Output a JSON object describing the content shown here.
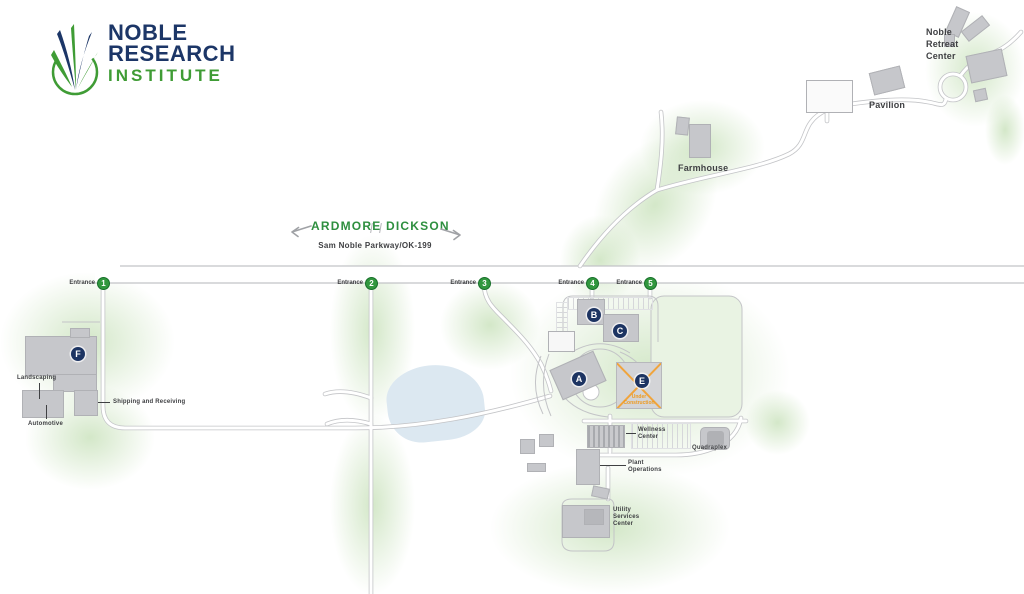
{
  "logo": {
    "line1": "NOBLE",
    "line2": "RESEARCH",
    "line3": "INSTITUTE"
  },
  "directions": {
    "west": "ARDMORE",
    "east": "DICKSON",
    "road": "Sam Noble Parkway/OK-199"
  },
  "entrances": [
    {
      "label": "Entrance",
      "number": "1"
    },
    {
      "label": "Entrance",
      "number": "2"
    },
    {
      "label": "Entrance",
      "number": "3"
    },
    {
      "label": "Entrance",
      "number": "4"
    },
    {
      "label": "Entrance",
      "number": "5"
    }
  ],
  "markers": {
    "a": "A",
    "b": "B",
    "c": "C",
    "e": "E",
    "f": "F"
  },
  "labels": {
    "noble_retreat_center": "Noble\nRetreat\nCenter",
    "pavilion": "Pavilion",
    "farmhouse": "Farmhouse",
    "landscaping": "Landscaping",
    "automotive": "Automotive",
    "shipping_receiving": "Shipping and Receiving",
    "wellness_center": "Wellness\nCenter",
    "quadraplex": "Quadraplex",
    "plant_operations": "Plant\nOperations",
    "utility_services_center": "Utility\nServices\nCenter",
    "under_construction": "Under\nConstruction"
  },
  "colors": {
    "navy": "#1c3667",
    "logo_green": "#3f9c35",
    "map_green": "#2f9540",
    "badge_green": "#31973e",
    "construction_orange": "#f0a43c",
    "building_gray": "#c6c7cb",
    "road_gray": "#c2c3c6",
    "pond_blue": "#dce8f1",
    "wash_green": "#dcedd2"
  }
}
